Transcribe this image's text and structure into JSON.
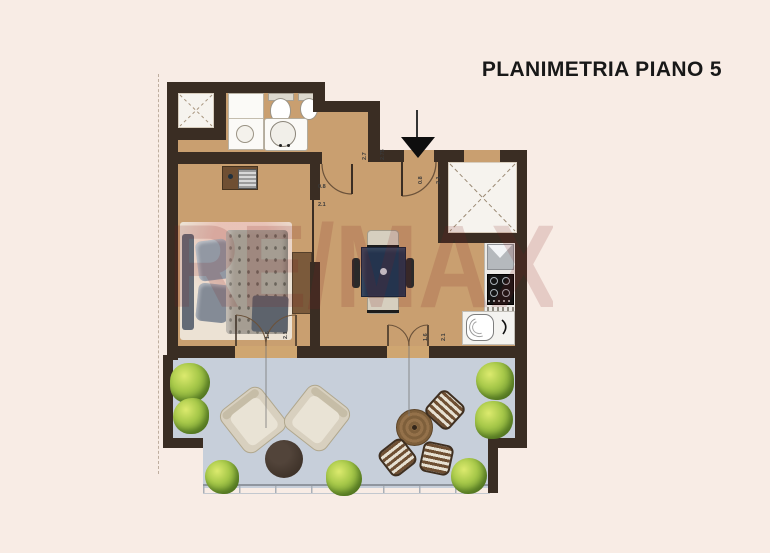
{
  "title": "PLANIMETRIA PIANO 5",
  "watermark": "RE/MAX",
  "dimensions": {
    "interior_door": {
      "w": "0.8",
      "h": "2.1"
    },
    "hall": {
      "a": "2.7",
      "b": "2.75"
    },
    "entry_door": {
      "w": "0.8",
      "h": "2.1"
    },
    "terrace_door_living": {
      "w": "1.6",
      "h": "2.1"
    },
    "terrace_door_bedroom": {
      "w": "1.6",
      "h": "2.1"
    }
  },
  "colors": {
    "background": "#f8ece5",
    "walls": "#3a2d23",
    "wood_floor": "#c99f70",
    "terrace_floor": "#c7cfda",
    "dining_table": "#24344e",
    "watermark_red": "#801e1c",
    "vegetation": "#8fbf3f"
  }
}
